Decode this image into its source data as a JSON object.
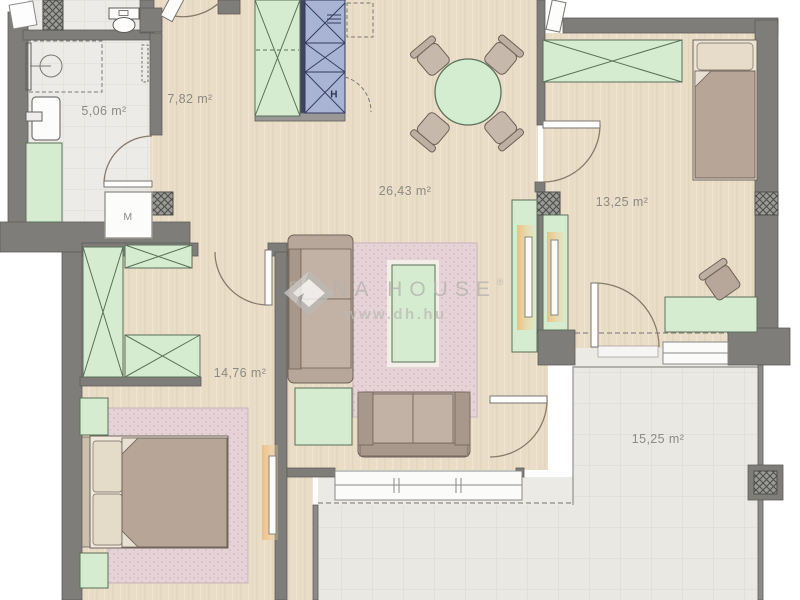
{
  "rooms": [
    {
      "id": "bathroom",
      "area_label": "5,06 m²"
    },
    {
      "id": "hall",
      "area_label": "7,82 m²"
    },
    {
      "id": "living-room-kitchen",
      "area_label": "26,43 m²"
    },
    {
      "id": "bedroom-right",
      "area_label": "13,25 m²"
    },
    {
      "id": "bedroom-left",
      "area_label": "14,76 m²"
    },
    {
      "id": "terrace",
      "area_label": "15,25 m²"
    }
  ],
  "appliances": {
    "washing_machine_label": "M",
    "fridge_label": "H"
  },
  "watermark": {
    "brand": "DUNA HOUSE",
    "registered": "®",
    "website": "www.dh.hu"
  },
  "colors": {
    "wall": "#7f7d7a",
    "wood_floor": "#e9ddc7",
    "bath_tile": "#ecebe7",
    "terrace_tile": "#e9e8e3",
    "furniture_green": "#d6ecd0",
    "kitchen_blue": "#a9b3d4",
    "rug_pink": "#e6d3d8",
    "sofa_brown": "#b7a79b",
    "label_text": "#8d8a83",
    "watermark_gray": "#b5b3ae"
  }
}
